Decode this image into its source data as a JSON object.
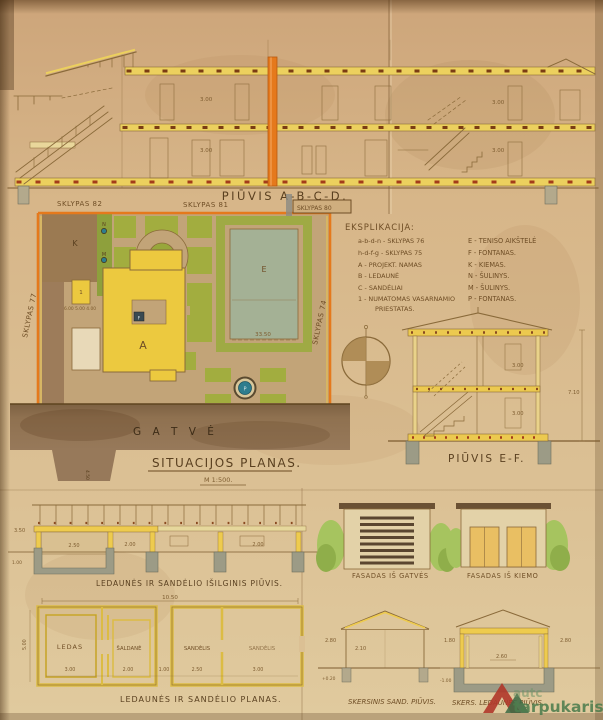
{
  "top_section": {
    "title": "PIŪVIS  A-B-C-D.",
    "dim_floor": "3.00"
  },
  "site_plan": {
    "title": "SITUACIJOS PLANAS.",
    "scale": "M 1:500.",
    "street": "G A T V Ė",
    "plot_82": "SKLYPAS 82",
    "plot_81": "SKLYPAS 81",
    "plot_80": "SKLYPAS 80",
    "plot_77": "SKLYPAS 77",
    "plot_74": "SKLYPAS 74",
    "k": "K",
    "e": "E",
    "a": "A",
    "f": "F",
    "p": "P",
    "n": "N",
    "m": "M",
    "annex": "1",
    "dim_tennis": "33.50",
    "dim_buildings": "6.00  5.00  4.00",
    "dim_drive": "4.50"
  },
  "legend": {
    "title": "EKSPLIKACIJA:",
    "left": [
      "a-b-d-n - SKLYPAS 76",
      "h-d-f-g - SKLYPAS 75",
      "A - PROJEKT. NAMAS",
      "B - LEDAUNĖ",
      "C - SANDĖLIAI",
      "1 - NUMATOMAS VASARNAMIO",
      "PRIESTATAS."
    ],
    "right": [
      "E - TENISO AIKŠTELĖ",
      "F - FONTANAS.",
      "K - KIEMAS.",
      "N - ŠULINYS.",
      "M - ŠULINYS.",
      "P - FONTANAS."
    ]
  },
  "section_ef": {
    "title": "PIŪVIS E-F.",
    "dim_floor": "3.00",
    "dim_total": "7.10"
  },
  "long_section": {
    "title": "LEDAUNĖS IR SANDĖLIO IŠILGINIS PIŪVIS.",
    "dim_h": "3.50",
    "dim_r1": "2.50",
    "dim_r2": "2.00",
    "dim_r3": "2.00",
    "dim_d": "1.00"
  },
  "icehouse_plan": {
    "title": "LEDAUNĖS IR SANDĖLIO PLANAS.",
    "dim_top": "10.50",
    "dim_left": "5.00",
    "room_ledas": "LEDAS",
    "room_saldane": "ŠALDANĖ",
    "room_sandelis1": "SANDĖLIS",
    "room_sandelis2": "SANDĖLIS",
    "dims_bottom": [
      "3.00",
      "2.00",
      "1.00",
      "2.50",
      "3.00"
    ]
  },
  "facade_street": {
    "title": "FASADAS IŠ GATVĖS"
  },
  "facade_yard": {
    "title": "FASADAS IŠ KIEMO"
  },
  "cross_sand": {
    "title": "SKERSINIS SAND. PIŪVIS.",
    "dim_left": "2.80",
    "dim_in": "2.10",
    "dim_base": "+0.20"
  },
  "cross_led": {
    "title": "SKERS. LEDAUNĖS PIŪVIS.",
    "dim_left": "1.80",
    "dim_in": "2.60",
    "dim_right": "2.80",
    "dim_base": "-1.00"
  },
  "watermark": {
    "brand": "autc",
    "label": "tarpukaris"
  },
  "colors": {
    "paper": "#d6b88b",
    "yellow": "#ecc94f",
    "orange": "#e5791c",
    "ink": "#6f4e26",
    "garden_green": "#a2ad3f",
    "street_brown": "#8a6c49",
    "tennis_court": "#a4b195",
    "fountain_teal": "#2e7d8e"
  }
}
